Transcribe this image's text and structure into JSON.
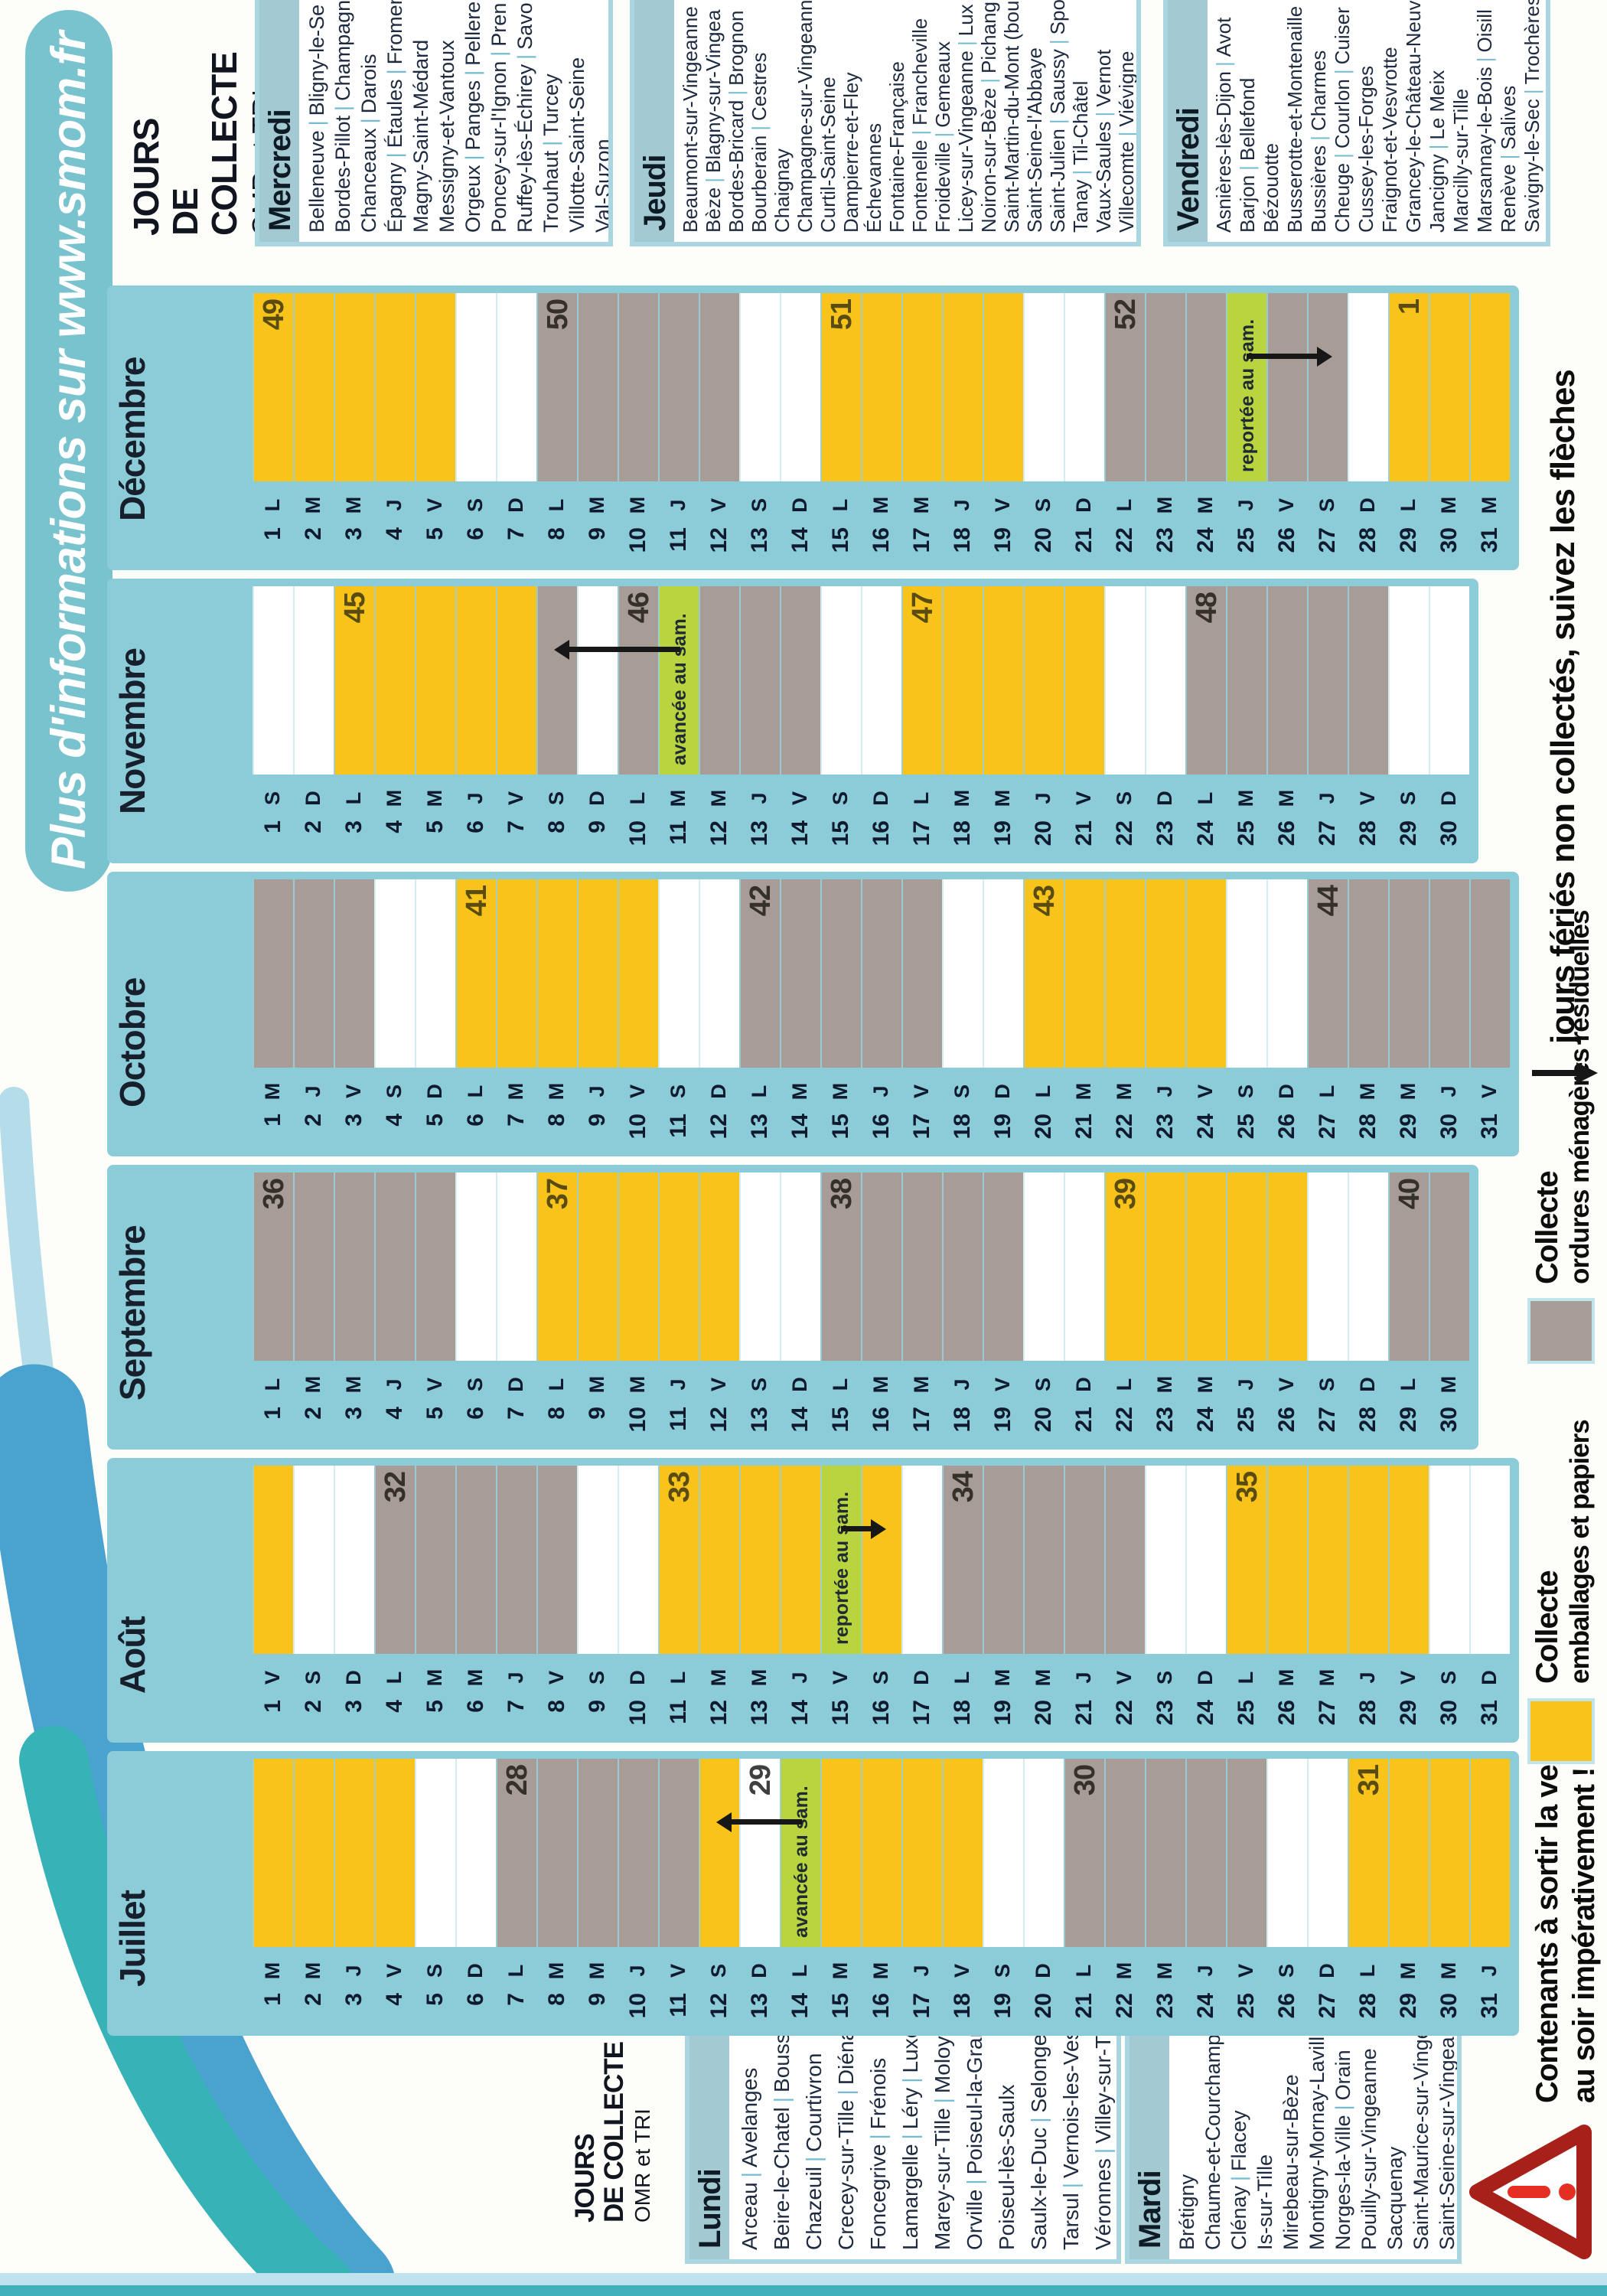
{
  "title": "Plus d'informations sur www.smom.fr",
  "collecte_heading": {
    "line1": "JOURS",
    "line2": "DE COLLECTE",
    "line3": "OMR et TRI"
  },
  "legend": {
    "emballages": {
      "title": "Collecte",
      "subtitle": "emballages et papiers",
      "color": "#f8c41c"
    },
    "omr": {
      "title": "Collecte",
      "subtitle": "ordures ménagères résiduelles",
      "color": "#a79d96"
    },
    "feries": {
      "text": "jours fériés non collectés, suivez les flèches"
    },
    "warning": {
      "line1": "Contenants à sortir la veille",
      "line2": "au soir impérativement !"
    }
  },
  "notes": {
    "avancee": "avancée au sam.",
    "reportee": "reportée au sam."
  },
  "weekday_lists": {
    "lundi": {
      "label": "Lundi",
      "items": [
        "Arceau | Avelanges",
        "Beire-le-Chatel | Boussenois",
        "Chazeuil | Courtivron",
        "Crecey-sur-Tille | Diénay",
        "Foncegrive | Frénois",
        "Lamargelle | Léry | Luxerois",
        "Marey-sur-Tille | Moloy",
        "Orville | Poiseul-la-Grange",
        "Poiseul-lès-Saulx",
        "Saulx-le-Duc | Selongey",
        "Tarsul | Vernois-les-Vesvres",
        "Véronnes | Villey-sur-Tille"
      ]
    },
    "mardi": {
      "label": "Mardi",
      "items": [
        "Brétigny",
        "Chaume-et-Courchamp",
        "Clénay | Flacey",
        "Is-sur-Tille",
        "Mirebeau-sur-Bèze",
        "Montigny-Mornay-Lavilleneuve",
        "Norges-la-Ville | Orain",
        "Pouilly-sur-Vingeanne",
        "Sacquenay",
        "Saint-Maurice-sur-Vingeanne",
        "Saint-Seine-sur-Vingeanne"
      ]
    },
    "mercredi": {
      "label": "Mercredi",
      "items": [
        "Belleneuve | Bligny-le-Se",
        "Bordes-Pillot | Champagn",
        "Chanceaux | Darois",
        "Épagny | Étaules | Fromen",
        "Magny-Saint-Médard",
        "Messigny-et-Vantoux",
        "Orgeux | Panges | Pellere",
        "Poncey-sur-l'Ignon | Pren",
        "Ruffey-lès-Échirey | Savo",
        "Trouhaut | Turcey",
        "Villotte-Saint-Seine",
        "Val-Suzon"
      ]
    },
    "jeudi": {
      "label": "Jeudi",
      "items": [
        "Beaumont-sur-Vingeanne",
        "Bèze | Blagny-sur-Vingea",
        "Bordes-Bricard | Brognon",
        "Bourberain | Cestres",
        "Chaignay",
        "Champagne-sur-Vingeann",
        "Curtil-Saint-Seine",
        "Dampierre-et-Fley",
        "Échevannes",
        "Fontaine-Française",
        "Fontenelle | Francheville",
        "Froideville | Gemeaux",
        "Licey-sur-Vingeanne | Lux",
        "Noiron-sur-Bèze | Pichang",
        "Saint-Martin-du-Mont (bou",
        "Saint-Seine-l'Abbaye",
        "Saint-Julien | Saussy | Spo",
        "Tanay | Til-Châtel",
        "Vaux-Saules | Vernot",
        "Villecomte | Viévigne"
      ]
    },
    "vendredi": {
      "label": "Vendredi",
      "items": [
        "Asnières-lès-Dijon | Avot",
        "Barjon | Bellefond",
        "Bézouotte",
        "Busserotte-et-Montenaille",
        "Bussières | Charmes",
        "Cheuge | Courlon | Cuiser",
        "Cussey-les-Forges",
        "Fraignot-et-Vesvrotte",
        "Grancey-le-Château-Neuvell",
        "Jancigny | Le Meix",
        "Marcilly-sur-Tille",
        "Marsannay-le-Bois | Oisill",
        "Renève | Salives",
        "Savigny-le-Sec | Trochères"
      ]
    }
  },
  "months": [
    {
      "name": "Juillet",
      "arrow": {
        "from": 14,
        "to": 12
      },
      "days": [
        [
          1,
          "M",
          "y"
        ],
        [
          2,
          "M",
          "y"
        ],
        [
          3,
          "J",
          "y"
        ],
        [
          4,
          "V",
          "y"
        ],
        [
          5,
          "S",
          "w"
        ],
        [
          6,
          "D",
          "w"
        ],
        [
          7,
          "L",
          "g",
          28
        ],
        [
          8,
          "M",
          "g"
        ],
        [
          9,
          "M",
          "g"
        ],
        [
          10,
          "J",
          "g"
        ],
        [
          11,
          "V",
          "g"
        ],
        [
          12,
          "S",
          "y"
        ],
        [
          13,
          "D",
          "w",
          29
        ],
        [
          14,
          "L",
          "v",
          null,
          "avancée au sam."
        ],
        [
          15,
          "M",
          "y"
        ],
        [
          16,
          "M",
          "y"
        ],
        [
          17,
          "J",
          "y"
        ],
        [
          18,
          "V",
          "y"
        ],
        [
          19,
          "S",
          "w"
        ],
        [
          20,
          "D",
          "w"
        ],
        [
          21,
          "L",
          "g",
          30
        ],
        [
          22,
          "M",
          "g"
        ],
        [
          23,
          "M",
          "g"
        ],
        [
          24,
          "J",
          "g"
        ],
        [
          25,
          "V",
          "g"
        ],
        [
          26,
          "S",
          "w"
        ],
        [
          27,
          "D",
          "w"
        ],
        [
          28,
          "L",
          "y",
          31
        ],
        [
          29,
          "M",
          "y"
        ],
        [
          30,
          "M",
          "y"
        ],
        [
          31,
          "J",
          "y"
        ]
      ]
    },
    {
      "name": "Août",
      "arrow": {
        "from": 15,
        "to": 16
      },
      "days": [
        [
          1,
          "V",
          "y"
        ],
        [
          2,
          "S",
          "w"
        ],
        [
          3,
          "D",
          "w"
        ],
        [
          4,
          "L",
          "g",
          32
        ],
        [
          5,
          "M",
          "g"
        ],
        [
          6,
          "M",
          "g"
        ],
        [
          7,
          "J",
          "g"
        ],
        [
          8,
          "V",
          "g"
        ],
        [
          9,
          "S",
          "w"
        ],
        [
          10,
          "D",
          "w"
        ],
        [
          11,
          "L",
          "y",
          33
        ],
        [
          12,
          "M",
          "y"
        ],
        [
          13,
          "M",
          "y"
        ],
        [
          14,
          "J",
          "y"
        ],
        [
          15,
          "V",
          "v",
          null,
          "reportée au sam."
        ],
        [
          16,
          "S",
          "y"
        ],
        [
          17,
          "D",
          "w"
        ],
        [
          18,
          "L",
          "g",
          34
        ],
        [
          19,
          "M",
          "g"
        ],
        [
          20,
          "M",
          "g"
        ],
        [
          21,
          "J",
          "g"
        ],
        [
          22,
          "V",
          "g"
        ],
        [
          23,
          "S",
          "w"
        ],
        [
          24,
          "D",
          "w"
        ],
        [
          25,
          "L",
          "y",
          35
        ],
        [
          26,
          "M",
          "y"
        ],
        [
          27,
          "M",
          "y"
        ],
        [
          28,
          "J",
          "y"
        ],
        [
          29,
          "V",
          "y"
        ],
        [
          30,
          "S",
          "w"
        ],
        [
          31,
          "D",
          "w"
        ]
      ]
    },
    {
      "name": "Septembre",
      "arrow": null,
      "days": [
        [
          1,
          "L",
          "g",
          36
        ],
        [
          2,
          "M",
          "g"
        ],
        [
          3,
          "M",
          "g"
        ],
        [
          4,
          "J",
          "g"
        ],
        [
          5,
          "V",
          "g"
        ],
        [
          6,
          "S",
          "w"
        ],
        [
          7,
          "D",
          "w"
        ],
        [
          8,
          "L",
          "y",
          37
        ],
        [
          9,
          "M",
          "y"
        ],
        [
          10,
          "M",
          "y"
        ],
        [
          11,
          "J",
          "y"
        ],
        [
          12,
          "V",
          "y"
        ],
        [
          13,
          "S",
          "w"
        ],
        [
          14,
          "D",
          "w"
        ],
        [
          15,
          "L",
          "g",
          38
        ],
        [
          16,
          "M",
          "g"
        ],
        [
          17,
          "M",
          "g"
        ],
        [
          18,
          "J",
          "g"
        ],
        [
          19,
          "V",
          "g"
        ],
        [
          20,
          "S",
          "w"
        ],
        [
          21,
          "D",
          "w"
        ],
        [
          22,
          "L",
          "y",
          39
        ],
        [
          23,
          "M",
          "y"
        ],
        [
          24,
          "M",
          "y"
        ],
        [
          25,
          "J",
          "y"
        ],
        [
          26,
          "V",
          "y"
        ],
        [
          27,
          "S",
          "w"
        ],
        [
          28,
          "D",
          "w"
        ],
        [
          29,
          "L",
          "g",
          40
        ],
        [
          30,
          "M",
          "g"
        ]
      ]
    },
    {
      "name": "Octobre",
      "arrow": null,
      "days": [
        [
          1,
          "M",
          "g"
        ],
        [
          2,
          "J",
          "g"
        ],
        [
          3,
          "V",
          "g"
        ],
        [
          4,
          "S",
          "w"
        ],
        [
          5,
          "D",
          "w"
        ],
        [
          6,
          "L",
          "y",
          41
        ],
        [
          7,
          "M",
          "y"
        ],
        [
          8,
          "M",
          "y"
        ],
        [
          9,
          "J",
          "y"
        ],
        [
          10,
          "V",
          "y"
        ],
        [
          11,
          "S",
          "w"
        ],
        [
          12,
          "D",
          "w"
        ],
        [
          13,
          "L",
          "g",
          42
        ],
        [
          14,
          "M",
          "g"
        ],
        [
          15,
          "M",
          "g"
        ],
        [
          16,
          "J",
          "g"
        ],
        [
          17,
          "V",
          "g"
        ],
        [
          18,
          "S",
          "w"
        ],
        [
          19,
          "D",
          "w"
        ],
        [
          20,
          "L",
          "y",
          43
        ],
        [
          21,
          "M",
          "y"
        ],
        [
          22,
          "M",
          "y"
        ],
        [
          23,
          "J",
          "y"
        ],
        [
          24,
          "V",
          "y"
        ],
        [
          25,
          "S",
          "w"
        ],
        [
          26,
          "D",
          "w"
        ],
        [
          27,
          "L",
          "g",
          44
        ],
        [
          28,
          "M",
          "g"
        ],
        [
          29,
          "M",
          "g"
        ],
        [
          30,
          "J",
          "g"
        ],
        [
          31,
          "V",
          "g"
        ]
      ]
    },
    {
      "name": "Novembre",
      "arrow": {
        "from": 11,
        "to": 8
      },
      "days": [
        [
          1,
          "S",
          "w"
        ],
        [
          2,
          "D",
          "w"
        ],
        [
          3,
          "L",
          "y",
          45
        ],
        [
          4,
          "M",
          "y"
        ],
        [
          5,
          "M",
          "y"
        ],
        [
          6,
          "J",
          "y"
        ],
        [
          7,
          "V",
          "y"
        ],
        [
          8,
          "S",
          "g"
        ],
        [
          9,
          "D",
          "w"
        ],
        [
          10,
          "L",
          "g",
          46
        ],
        [
          11,
          "M",
          "v",
          null,
          "avancée au sam."
        ],
        [
          12,
          "M",
          "g"
        ],
        [
          13,
          "J",
          "g"
        ],
        [
          14,
          "V",
          "g"
        ],
        [
          15,
          "S",
          "w"
        ],
        [
          16,
          "D",
          "w"
        ],
        [
          17,
          "L",
          "y",
          47
        ],
        [
          18,
          "M",
          "y"
        ],
        [
          19,
          "M",
          "y"
        ],
        [
          20,
          "J",
          "y"
        ],
        [
          21,
          "V",
          "y"
        ],
        [
          22,
          "S",
          "w"
        ],
        [
          23,
          "D",
          "w"
        ],
        [
          24,
          "L",
          "g",
          48
        ],
        [
          25,
          "M",
          "g"
        ],
        [
          26,
          "M",
          "g"
        ],
        [
          27,
          "J",
          "g"
        ],
        [
          28,
          "V",
          "g"
        ],
        [
          29,
          "S",
          "w"
        ],
        [
          30,
          "D",
          "w"
        ]
      ]
    },
    {
      "name": "Décembre",
      "arrow": {
        "from": 25,
        "to": 27
      },
      "days": [
        [
          1,
          "L",
          "y",
          49
        ],
        [
          2,
          "M",
          "y"
        ],
        [
          3,
          "M",
          "y"
        ],
        [
          4,
          "J",
          "y"
        ],
        [
          5,
          "V",
          "y"
        ],
        [
          6,
          "S",
          "w"
        ],
        [
          7,
          "D",
          "w"
        ],
        [
          8,
          "L",
          "g",
          50
        ],
        [
          9,
          "M",
          "g"
        ],
        [
          10,
          "M",
          "g"
        ],
        [
          11,
          "J",
          "g"
        ],
        [
          12,
          "V",
          "g"
        ],
        [
          13,
          "S",
          "w"
        ],
        [
          14,
          "D",
          "w"
        ],
        [
          15,
          "L",
          "y",
          51
        ],
        [
          16,
          "M",
          "y"
        ],
        [
          17,
          "M",
          "y"
        ],
        [
          18,
          "J",
          "y"
        ],
        [
          19,
          "V",
          "y"
        ],
        [
          20,
          "S",
          "w"
        ],
        [
          21,
          "D",
          "w"
        ],
        [
          22,
          "L",
          "g",
          52
        ],
        [
          23,
          "M",
          "g"
        ],
        [
          24,
          "M",
          "g"
        ],
        [
          25,
          "J",
          "v",
          null,
          "reportée au sam."
        ],
        [
          26,
          "V",
          "g"
        ],
        [
          27,
          "S",
          "g"
        ],
        [
          28,
          "D",
          "w"
        ],
        [
          29,
          "L",
          "y",
          1
        ],
        [
          30,
          "M",
          "y"
        ],
        [
          31,
          "M",
          "y"
        ]
      ]
    }
  ]
}
